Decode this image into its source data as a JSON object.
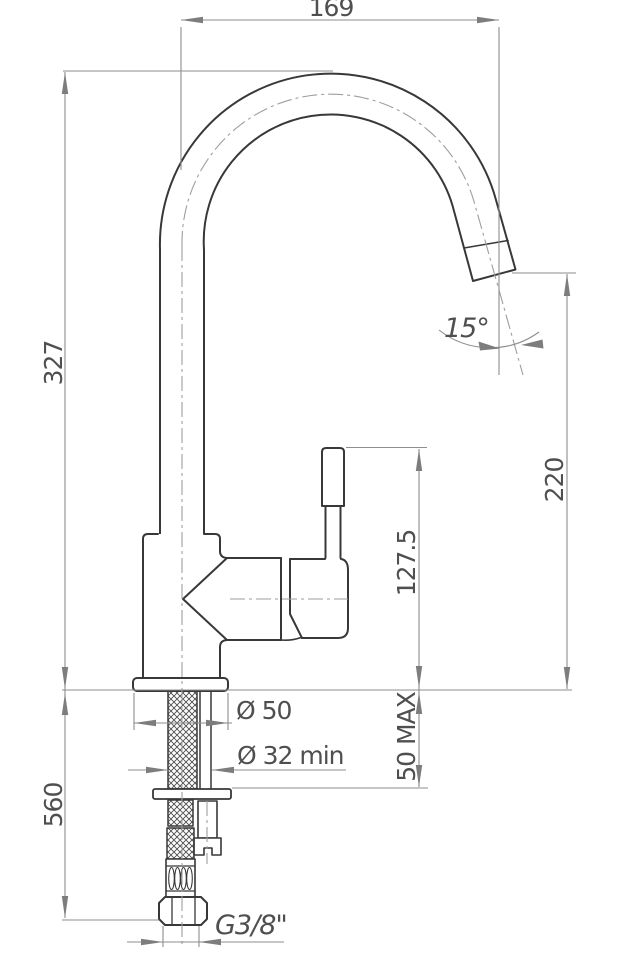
{
  "dimensions": {
    "spout_reach": "169",
    "spout_height": "327",
    "below_deck_length": "560",
    "outlet_height": "220",
    "handle_height": "127.5",
    "deck_thickness_max": "50 MAX",
    "base_diameter": "Ø 50",
    "mounting_hole_diameter": "Ø 32 min",
    "connection_thread": "G3/8\"",
    "outlet_angle": "15°"
  },
  "colors": {
    "object_line": "#383838",
    "dimension_line": "#8e8e8e",
    "centerline": "#9e9e9e",
    "text": "#4f4f4f",
    "background": "#ffffff"
  }
}
